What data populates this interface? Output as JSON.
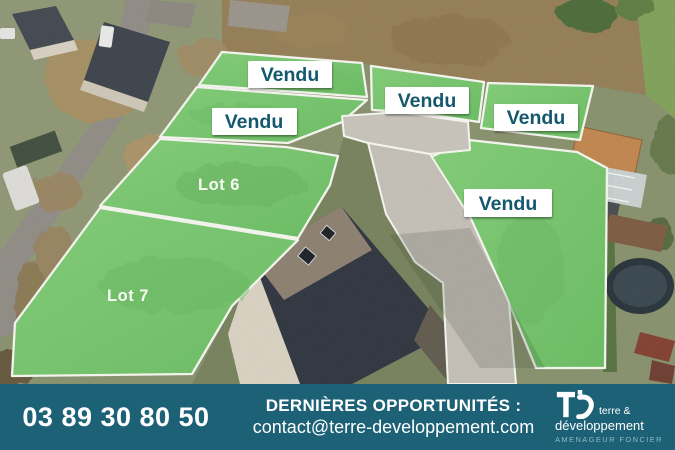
{
  "plots": {
    "sold": [
      "Vendu",
      "Vendu",
      "Vendu",
      "Vendu",
      "Vendu"
    ],
    "available": [
      "Lot 6",
      "Lot 7"
    ]
  },
  "banner": {
    "phone": "03 89 30 80 50",
    "headline": "DERNIÈRES OPPORTUNITÉS :",
    "email": "contact@terre-developpement.com",
    "logo": {
      "name_top": "terre &",
      "name_bottom": "développement",
      "tagline": "AMENAGEUR FONCIER"
    }
  },
  "colors": {
    "overlay_green": "#74c36b",
    "plot_border": "#f4f6ef",
    "label_box": "#ffffff",
    "label_text": "#14586e",
    "lot_text": "#fbfdf8",
    "banner_bg": "#1d6176",
    "banner_text": "#ffffff",
    "tagline_text": "#8fb9c6",
    "road_gray": "#c5c0b8"
  }
}
